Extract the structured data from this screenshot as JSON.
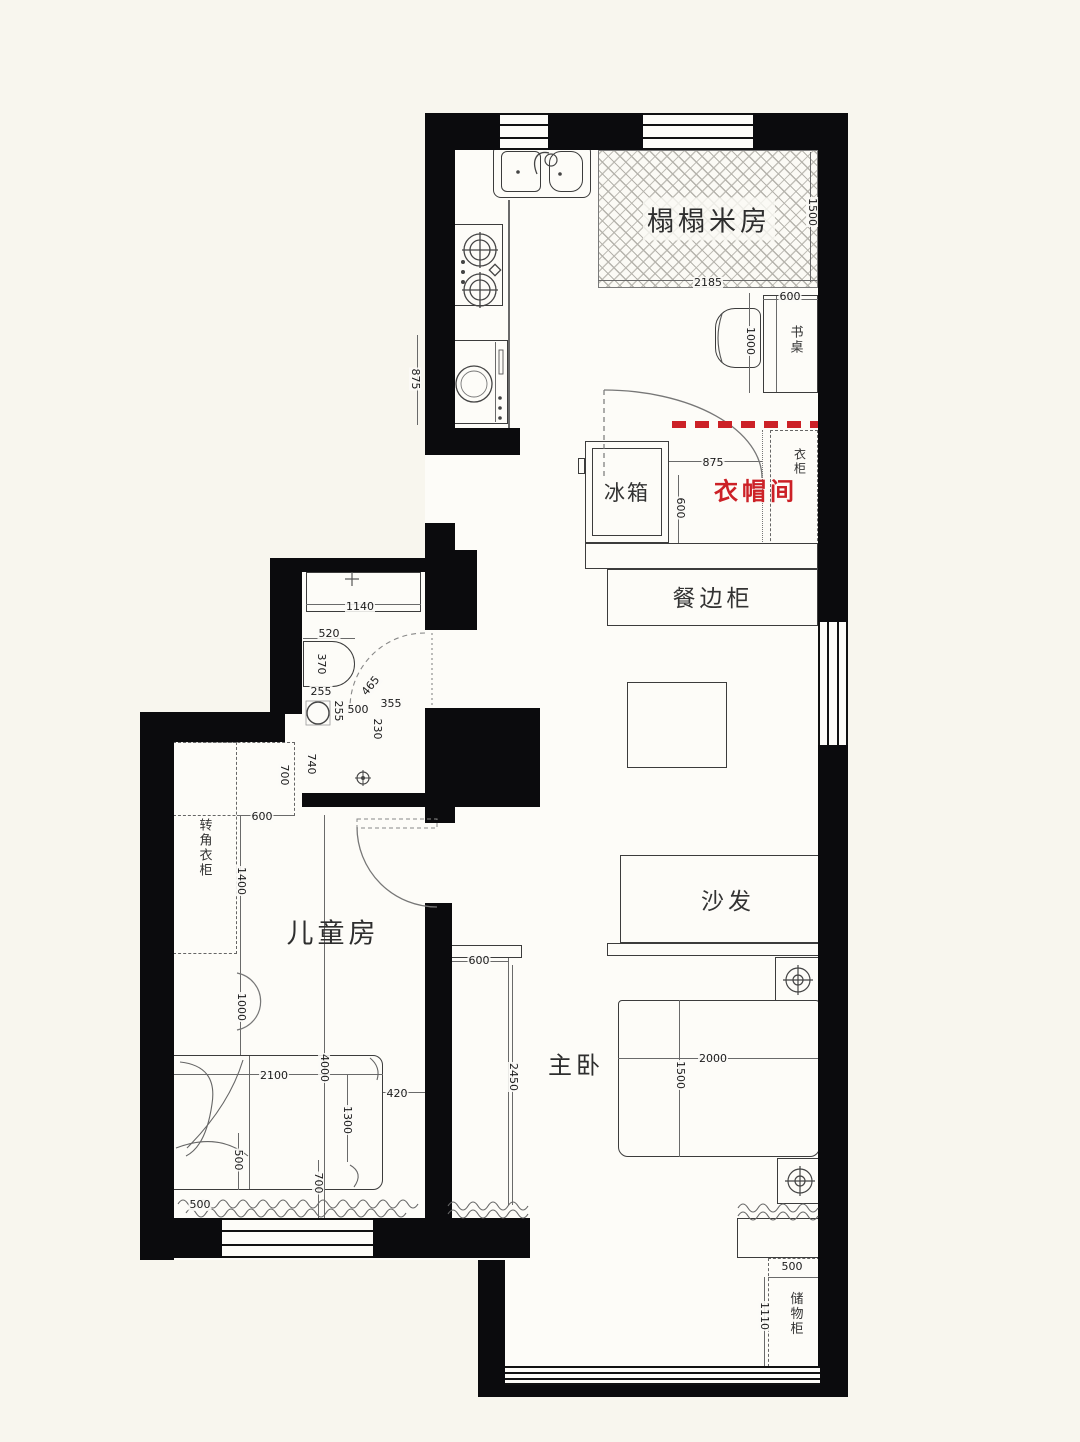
{
  "title": "apartment-floor-plan",
  "colors": {
    "wall": "#0b0b0d",
    "paper": "#f8f6ee",
    "accent_red": "#cc2127",
    "line": "#3c3c3c"
  },
  "rooms": {
    "tatami": "榻榻米房",
    "cloakroom": "衣帽间",
    "children": "儿童房",
    "master": "主卧"
  },
  "furniture": {
    "desk": "书桌",
    "wardrobe": "衣柜",
    "fridge": "冰箱",
    "sideboard": "餐边柜",
    "sofa": "沙发",
    "corner_wardrobe": "转角衣柜",
    "storage": "储物柜"
  },
  "dimensions": [
    {
      "t": "1500",
      "x": 812,
      "y": 212,
      "r": 90
    },
    {
      "t": "2185",
      "x": 708,
      "y": 283,
      "r": 0
    },
    {
      "t": "600",
      "x": 790,
      "y": 297,
      "r": 0
    },
    {
      "t": "1000",
      "x": 750,
      "y": 341,
      "r": 90
    },
    {
      "t": "875",
      "x": 415,
      "y": 379,
      "r": 90
    },
    {
      "t": "875",
      "x": 713,
      "y": 463,
      "r": 0
    },
    {
      "t": "600",
      "x": 680,
      "y": 508,
      "r": 90
    },
    {
      "t": "1140",
      "x": 360,
      "y": 607,
      "r": 0
    },
    {
      "t": "520",
      "x": 329,
      "y": 634,
      "r": 0
    },
    {
      "t": "370",
      "x": 321,
      "y": 664,
      "r": 90
    },
    {
      "t": "255",
      "x": 321,
      "y": 692,
      "r": 0
    },
    {
      "t": "255",
      "x": 338,
      "y": 711,
      "r": 90
    },
    {
      "t": "500",
      "x": 358,
      "y": 710,
      "r": 0
    },
    {
      "t": "355",
      "x": 391,
      "y": 704,
      "r": 0
    },
    {
      "t": "465",
      "x": 371,
      "y": 686,
      "r": -50
    },
    {
      "t": "230",
      "x": 377,
      "y": 729,
      "r": 90
    },
    {
      "t": "740",
      "x": 311,
      "y": 764,
      "r": 90
    },
    {
      "t": "700",
      "x": 284,
      "y": 775,
      "r": 90
    },
    {
      "t": "600",
      "x": 262,
      "y": 817,
      "r": 0
    },
    {
      "t": "1400",
      "x": 241,
      "y": 881,
      "r": 90
    },
    {
      "t": "1000",
      "x": 241,
      "y": 1007,
      "r": 90
    },
    {
      "t": "2100",
      "x": 274,
      "y": 1076,
      "r": 0
    },
    {
      "t": "4000",
      "x": 324,
      "y": 1068,
      "r": 90
    },
    {
      "t": "1300",
      "x": 347,
      "y": 1120,
      "r": 90
    },
    {
      "t": "420",
      "x": 397,
      "y": 1094,
      "r": 0
    },
    {
      "t": "500",
      "x": 238,
      "y": 1160,
      "r": 90
    },
    {
      "t": "700",
      "x": 318,
      "y": 1183,
      "r": 90
    },
    {
      "t": "500",
      "x": 200,
      "y": 1205,
      "r": 0
    },
    {
      "t": "600",
      "x": 479,
      "y": 961,
      "r": 0
    },
    {
      "t": "2450",
      "x": 513,
      "y": 1077,
      "r": 90
    },
    {
      "t": "2000",
      "x": 713,
      "y": 1059,
      "r": 0
    },
    {
      "t": "1500",
      "x": 680,
      "y": 1075,
      "r": 90
    },
    {
      "t": "500",
      "x": 792,
      "y": 1267,
      "r": 0
    },
    {
      "t": "1110",
      "x": 764,
      "y": 1316,
      "r": 90
    }
  ]
}
